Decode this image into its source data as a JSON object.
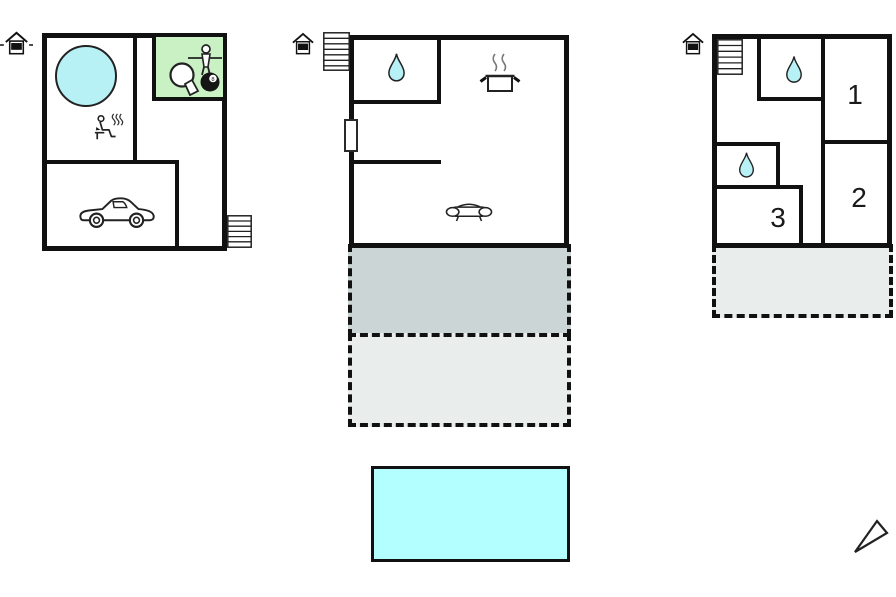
{
  "colors": {
    "wall": "#111111",
    "water_feature": "#b7f1f6",
    "pool": "#b3feff",
    "games_room_bg": "#c9f1c4",
    "terrace_upper": "#cbd5d6",
    "terrace_lower": "#e9eeec",
    "steam": "#777777",
    "outline": "#222222"
  },
  "floorplan": {
    "room_labels": {
      "room1": "1",
      "room2": "2",
      "room3": "3"
    },
    "eight_ball_label": "8",
    "icons": [
      "entrance-icon",
      "stairs-icon",
      "hot-tub-icon",
      "sauna-icon",
      "table-tennis-icon",
      "foosball-player-icon",
      "billiard-8ball-icon",
      "car-icon",
      "water-drop-icon",
      "cooking-pot-icon",
      "sofa-icon",
      "window-icon",
      "compass-icon"
    ]
  }
}
